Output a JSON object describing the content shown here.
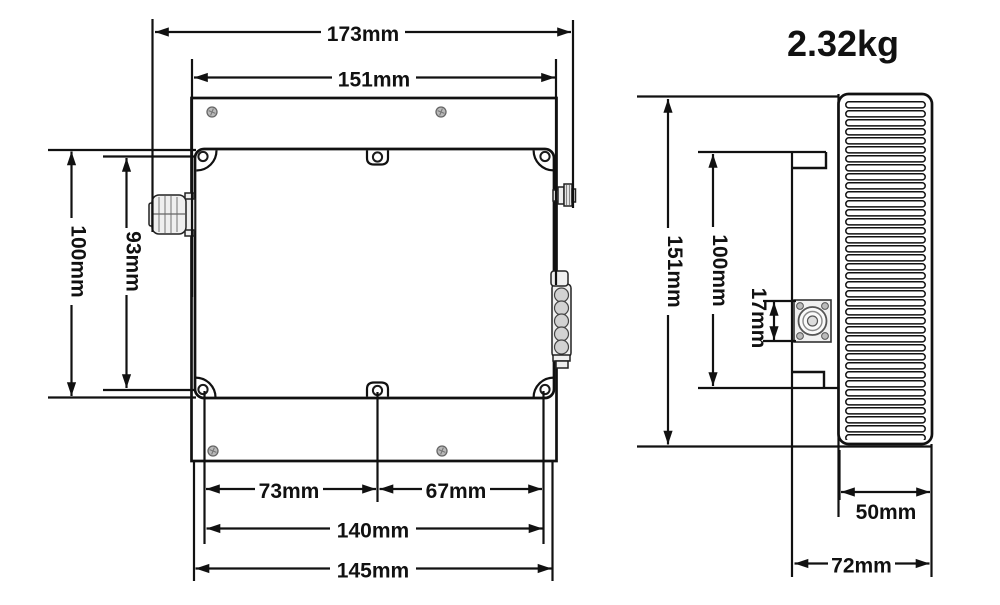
{
  "side_view": {
    "weight": "2.32kg",
    "dims": {
      "total_height": "151mm",
      "body_height": "100mm",
      "connector_height": "17mm",
      "heatsink_depth": "50mm",
      "total_depth": "72mm"
    }
  },
  "top_view": {
    "dims": {
      "overall_width": "173mm",
      "flange_width": "151mm",
      "overall_height": "100mm",
      "mount_hole_vertical_span": "93mm",
      "hole_left_offset": "73mm",
      "hole_right_offset": "67mm",
      "mount_hole_horizontal_span": "140mm",
      "body_width": "145mm"
    }
  }
}
